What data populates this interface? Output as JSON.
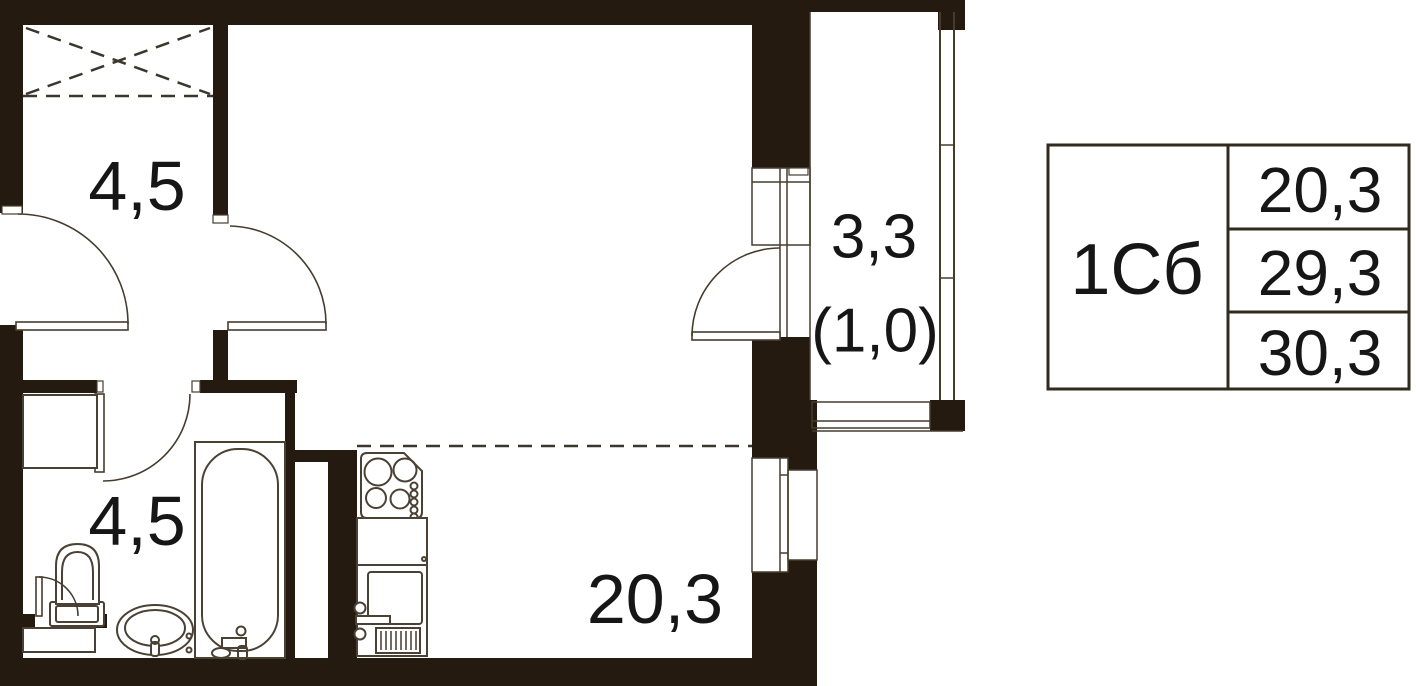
{
  "plan": {
    "rooms": {
      "hallway": {
        "area": "4,5"
      },
      "bathroom": {
        "area": "4,5"
      },
      "living_kitchen": {
        "area": "20,3"
      },
      "loggia": {
        "area": "3,3",
        "area_coeff": "(1,0)"
      }
    }
  },
  "info_table": {
    "plan_code": "1Сб",
    "areas": {
      "living": "20,3",
      "apartment": "29,3",
      "total": "30,3"
    }
  },
  "colors": {
    "wall": "#241a10",
    "line": "#463c2e",
    "text": "#161616",
    "table_border": "#322a1c",
    "background": "#ffffff"
  }
}
